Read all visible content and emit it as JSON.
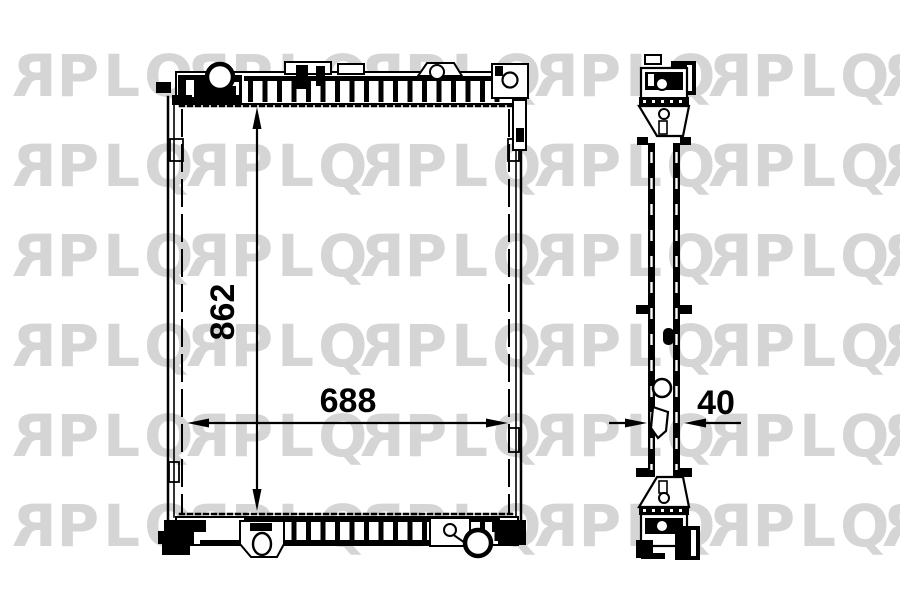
{
  "watermark": {
    "text": "RPLQ",
    "color": "#d5d5d5"
  },
  "dimensions": {
    "height_label": "862",
    "width_label": "688",
    "depth_label": "40"
  },
  "colors": {
    "line": "#000000",
    "background": "#ffffff",
    "watermark": "#d5d5d5"
  }
}
